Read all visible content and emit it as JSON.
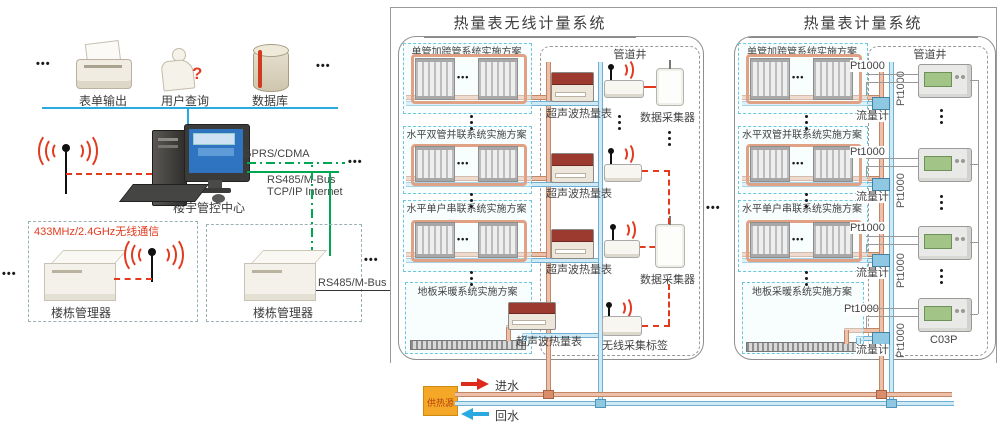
{
  "ellipsis": "•••",
  "left": {
    "items": [
      {
        "label": "表单输出"
      },
      {
        "label": "用户查询"
      },
      {
        "label": "数据库"
      }
    ],
    "query_mark": "?",
    "control_center": "楼宇管控中心",
    "link_gprs": "GPRS/CDMA",
    "link_rs485": "RS485/M-Bus",
    "link_tcpip": "TCP/IP Internet",
    "wireless_433": "433MHz/2.4GHz无线通信",
    "manager_left": "楼栋管理器",
    "manager_right": "楼栋管理器",
    "rs485_bus": "RS485/M-Bus"
  },
  "wireless_system": {
    "title": "热量表无线计量系统",
    "schemes": [
      {
        "label": "单管加跨管系统实施方案"
      },
      {
        "label": "水平双管并联系统实施方案"
      },
      {
        "label": "水平单户串联系统实施方案"
      },
      {
        "label": "地板采暖系统实施方案"
      }
    ],
    "pipe_well": "管道井",
    "meter": "超声波热量表",
    "collector": "数据采集器",
    "tag": "无线采集标签"
  },
  "wired_system": {
    "title": "热量表计量系统",
    "schemes": [
      {
        "label": "单管加跨管系统实施方案"
      },
      {
        "label": "水平双管并联系统实施方案"
      },
      {
        "label": "水平单户串联系统实施方案"
      },
      {
        "label": "地板采暖系统实施方案"
      }
    ],
    "pipe_well": "管道井",
    "pt1000": "Pt1000",
    "flow_meter": "流量计",
    "calculator_model": "C03P"
  },
  "heat_source": {
    "label": "供热源",
    "supply": "进水",
    "return": "回水"
  },
  "colors": {
    "red": "#e23a1e",
    "green": "#00a651",
    "bus_blue": "#29abe2",
    "warm_pipe": "#eec0aa",
    "cool_pipe": "#cfeaf5",
    "orange": "#f5a828"
  }
}
